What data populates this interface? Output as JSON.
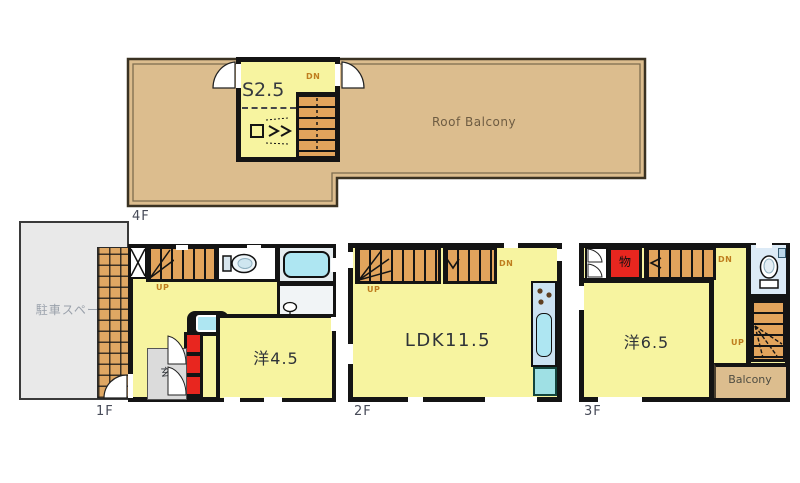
{
  "floor4": {
    "floor_label": "4F",
    "room_label": "S2.5",
    "stair_down_label": "DN",
    "balcony_label": "Roof Balcony"
  },
  "floor1": {
    "floor_label": "1F",
    "parking_label": "駐車スペース",
    "stair_up_label": "UP",
    "room_label": "洋4.5",
    "entrance_label": "玄"
  },
  "floor2": {
    "floor_label": "2F",
    "room_label": "LDK11.5",
    "stair_up_label": "UP",
    "stair_down_label": "DN"
  },
  "floor3": {
    "floor_label": "3F",
    "room_label": "洋6.5",
    "storage_label": "物",
    "stair_up_label": "UP",
    "stair_down_label": "DN",
    "balcony_label": "Balcony"
  },
  "colors": {
    "wall": "#141414",
    "room_yellow": "#F7F4A0",
    "balcony_tan": "#DCBD8E",
    "stair_orange": "#E2A45C",
    "tile_orange": "#DFA763",
    "storage_red": "#E8261F",
    "water_cyan": "#AEE6F2",
    "counter_blue": "#CCE2F2",
    "toilet_blue": "#DCEAF6",
    "parking_gray": "#E9E9E9"
  }
}
